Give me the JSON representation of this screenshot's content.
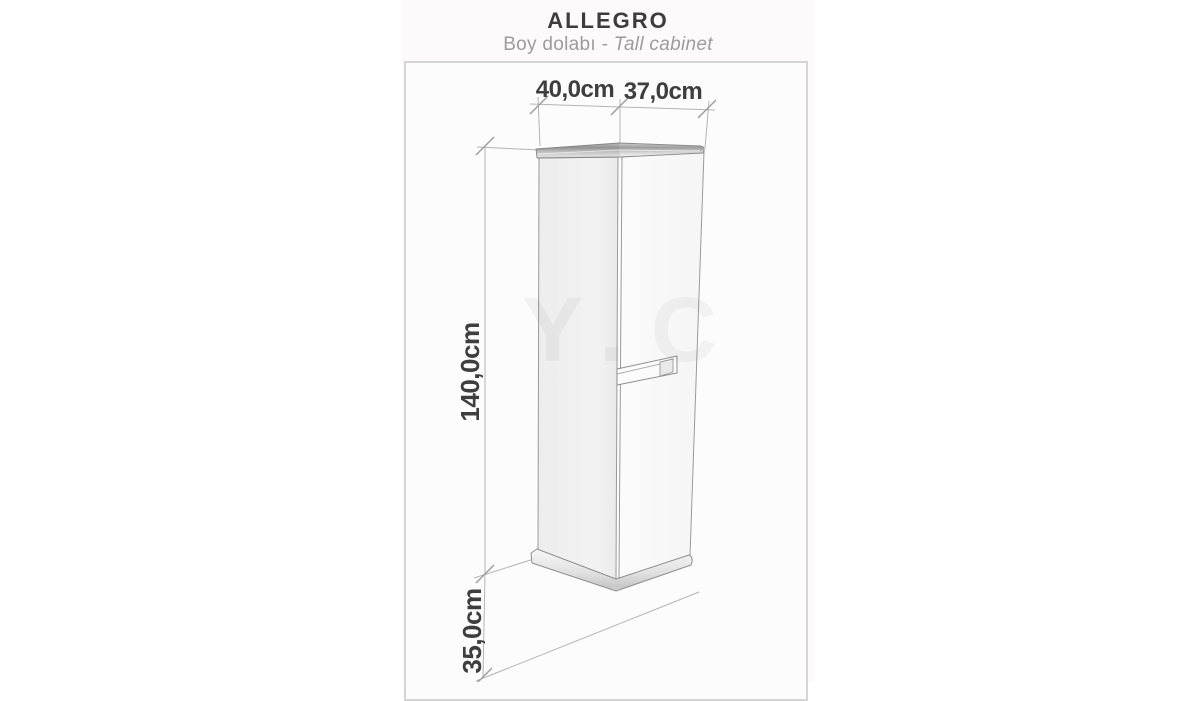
{
  "header": {
    "title": "ALLEGRO",
    "subtitle_primary": "Boy dolabı",
    "subtitle_separator": " - ",
    "subtitle_secondary": "Tall cabinet"
  },
  "diagram": {
    "kind": "furniture-dimension-drawing",
    "product_name": "ALLEGRO",
    "product_type_tr": "Boy dolabı",
    "product_type_en": "Tall cabinet",
    "watermark": "Y.C",
    "dimensions": {
      "top_width": {
        "label": "40,0cm",
        "value_cm": 40.0
      },
      "top_depth": {
        "label": "37,0cm",
        "value_cm": 37.0
      },
      "body_height": {
        "label": "140,0cm",
        "value_cm": 140.0
      },
      "floor_clearance": {
        "label": "35,0cm",
        "value_cm": 35.0
      }
    },
    "colors": {
      "title_text": "#3c3c3c",
      "subtitle_text": "#9c9c9c",
      "dimension_label_text": "#3e3e3e",
      "cabinet_line": "#969696",
      "dimension_line": "#b4b4b4",
      "frame_border": "#d5d5d5",
      "panel_background": "#fcfafa"
    }
  }
}
